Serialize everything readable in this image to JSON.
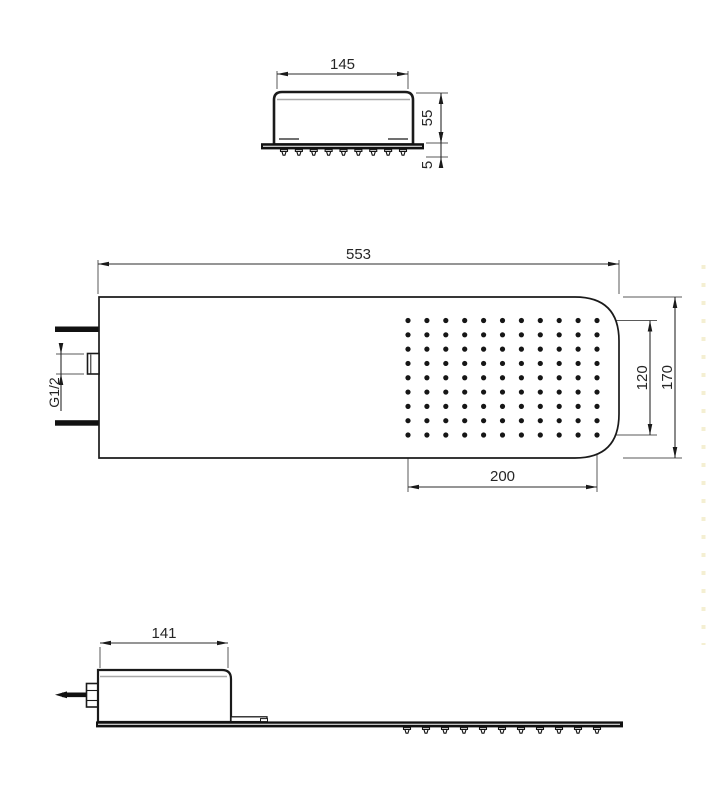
{
  "drawing_title": "Shower head dimensional drawing",
  "colors": {
    "outline": "#1a1a1a",
    "dim_line": "#2b2b2b",
    "ext_line": "#5a5a5a",
    "inner_line": "#a8a8a8",
    "fill": "#ffffff",
    "solid": "#111111",
    "dot": "#161616",
    "watermark": "#ece2ae"
  },
  "views": {
    "end_view": {
      "name": "end-view",
      "dims": {
        "width": "145",
        "height": "55",
        "plate": "5"
      },
      "nozzle_count": 9
    },
    "plan_view": {
      "name": "plan-view",
      "dims": {
        "length": "553",
        "height": "170",
        "grid_h": "120",
        "grid_w": "200",
        "thread": "G1/2"
      },
      "spray_grid": {
        "columns": 11,
        "rows": 9
      }
    },
    "side_view": {
      "name": "side-view",
      "dims": {
        "length": "141"
      },
      "nozzle_count": 11
    }
  }
}
